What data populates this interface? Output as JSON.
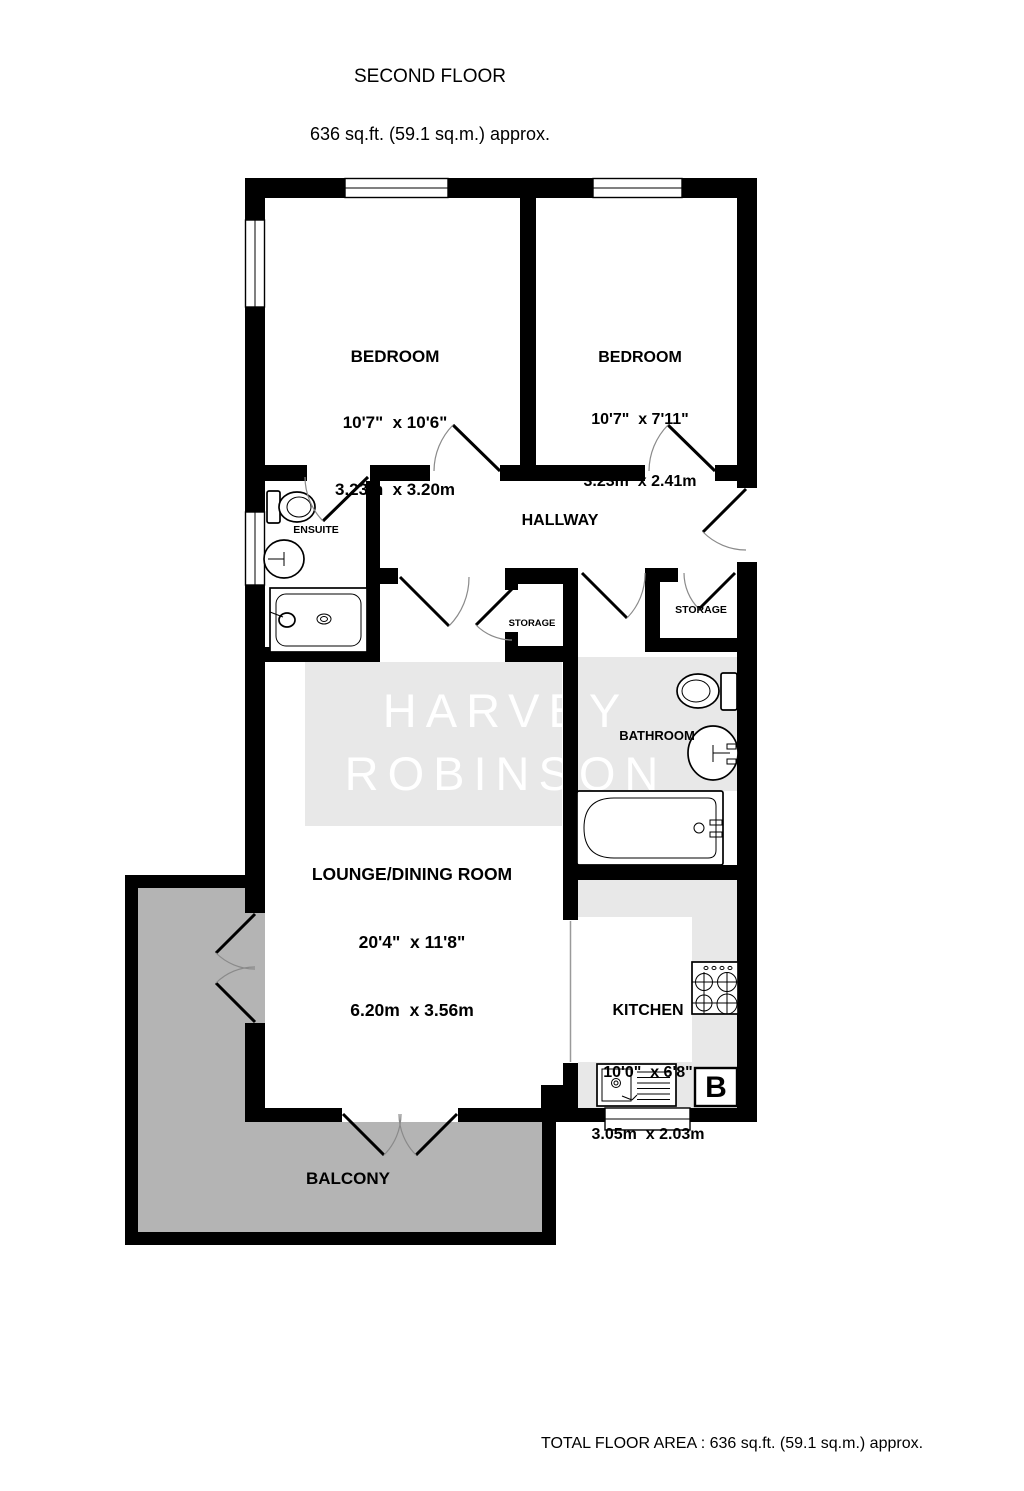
{
  "header": {
    "title": "SECOND FLOOR",
    "subtitle": "636 sq.ft. (59.1 sq.m.) approx."
  },
  "watermark": {
    "line1": "HARVEY",
    "line2": "ROBINSON"
  },
  "rooms": {
    "bedroom1": {
      "name": "BEDROOM",
      "imperial": "10'7\"  x 10'6\"",
      "metric": "3.23m  x 3.20m"
    },
    "bedroom2": {
      "name": "BEDROOM",
      "imperial": "10'7\"  x 7'11\"",
      "metric": "3.23m  x 2.41m"
    },
    "lounge": {
      "name": "LOUNGE/DINING ROOM",
      "imperial": "20'4\"  x 11'8\"",
      "metric": "6.20m  x 3.56m"
    },
    "kitchen": {
      "name": "KITCHEN",
      "imperial": "10'0\"  x 6'8\"",
      "metric": "3.05m  x 2.03m"
    },
    "hallway": {
      "name": "HALLWAY"
    },
    "ensuite": {
      "name": "ENSUITE"
    },
    "bathroom": {
      "name": "BATHROOM"
    },
    "storage_left": {
      "name": "STORAGE"
    },
    "storage_right": {
      "name": "STORAGE"
    },
    "balcony": {
      "name": "BALCONY"
    }
  },
  "boiler": {
    "label": "B"
  },
  "footer": {
    "total_area": "TOTAL FLOOR AREA : 636 sq.ft. (59.1 sq.m.) approx.",
    "credit": "Made with Metropix ©2026"
  },
  "colors": {
    "wall": "#000000",
    "text": "#000000",
    "balcony_floor": "#b4b4b4",
    "watermark_panel": "#e8e8e8",
    "kitchen_counter": "#e8e8e8",
    "watermark_text": "#ffffff",
    "door_arc": "#8a8a8a",
    "opening_line": "#9a9a9a"
  }
}
